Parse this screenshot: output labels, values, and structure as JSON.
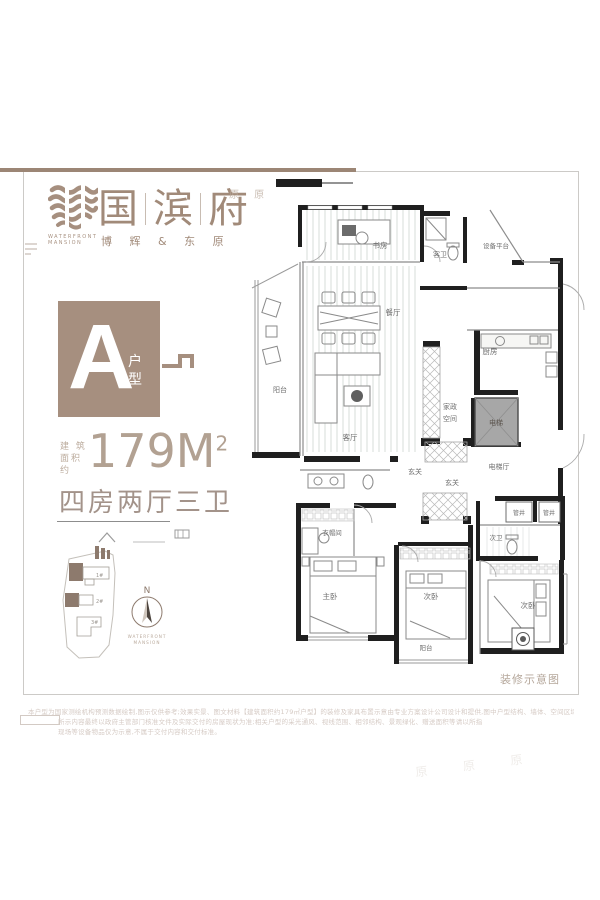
{
  "brand": {
    "cn": [
      "国",
      "滨",
      "府"
    ],
    "en1": "WATERFRONT",
    "en2": "MANSION",
    "subtitle": "博 辉 & 东 原",
    "watermark": "原 原",
    "watermark_br": "原 原 原"
  },
  "unit": {
    "letter": "A",
    "type_char1": "户",
    "type_char2": "型",
    "area_label_line1": "建 筑",
    "area_label_line2": "面积约",
    "area_value": "179M",
    "area_exponent": "2",
    "layout_summary": "四房两厅三卫"
  },
  "siteplan": {
    "building1": "1#",
    "building2": "2#",
    "building3": "3#",
    "north": "N",
    "caption_line1": "WATERFRONT",
    "caption_line2": "MANSION"
  },
  "floorplan": {
    "caption": "装修示意图",
    "rooms": {
      "study": "书房",
      "guest_bath": "客卫",
      "equipment_platform": "设备平台",
      "dining": "餐厅",
      "balcony_main": "阳台",
      "living": "客厅",
      "kitchen": "厨房",
      "housekeeping_line1": "家政",
      "housekeeping_line2": "空间",
      "elevator": "电梯",
      "hall_inner": "玄关",
      "hall_entry": "玄关",
      "elevator_hall": "电梯厅",
      "shaft1": "管井",
      "shaft2": "管井",
      "bath2": "次卫",
      "cloakroom": "衣帽间",
      "master": "主卧",
      "bedroom2": "次卧",
      "bedroom3": "次卧",
      "balcony2": "阳台"
    }
  },
  "disclaimer": {
    "line1": "本户型为国家测绘机构预测数据绘制,图示仅供参考;效果实景、图文材料【建筑面积约179㎡户型】的装修及家具布置示意由专业方案设计公司设计和提供,图中户型结构、墙体、空间区域等进行了适当优化处理",
    "line2": "所示内容最终以政府主管部门核准文件及实际交付的房屋现状为准;相关户型的采光通风、视线范围、相邻结构、景观绿化、赠送面积等请以所指",
    "line3": "现场等设备物品仅为示意,不属于交付内容和交付标准。"
  },
  "colors": {
    "accent": "#a68f7f",
    "accent_light": "#b5a79b",
    "wall": "#1f1f1f",
    "frame": "#cccac7"
  }
}
